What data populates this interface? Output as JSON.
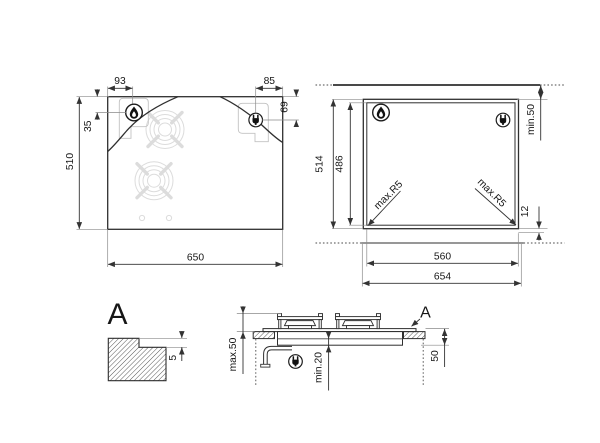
{
  "page": {
    "background": "#ffffff",
    "line_color": "#2f2f2f",
    "faint_color": "#dcdcdc"
  },
  "top_view": {
    "width_label": "650",
    "height_label": "510",
    "burner_offset_x": "93",
    "burner_offset_y": "35",
    "socket_offset_x": "85",
    "socket_offset_y": "69",
    "burner_icon": "flame-icon",
    "socket_icon": "plug-icon"
  },
  "cutout_view": {
    "outer_height": "514",
    "inner_height": "486",
    "inner_width": "560",
    "outer_width": "654",
    "wall_clearance": "min.50",
    "rear_gap": "12",
    "radius_left": "max.R5",
    "radius_right": "max.R5",
    "burner_icon": "flame-icon",
    "socket_icon": "plug-icon"
  },
  "detail_view": {
    "label": "A",
    "step_depth": "5"
  },
  "section_view": {
    "label": "A",
    "height_above": "max.50",
    "clearance_below": "min.20",
    "side_depth": "50",
    "socket_icon": "plug-icon"
  }
}
